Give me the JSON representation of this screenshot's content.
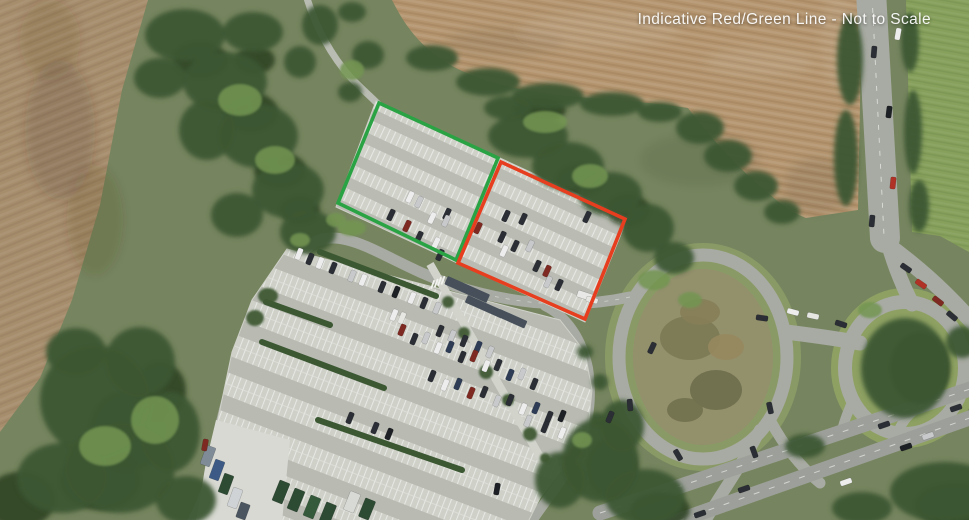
{
  "annotation": {
    "label": "Indicative Red/Green Line - Not to Scale"
  },
  "legend": {
    "green_line_color": "#2aa344",
    "red_line_color": "#e63e1f"
  }
}
